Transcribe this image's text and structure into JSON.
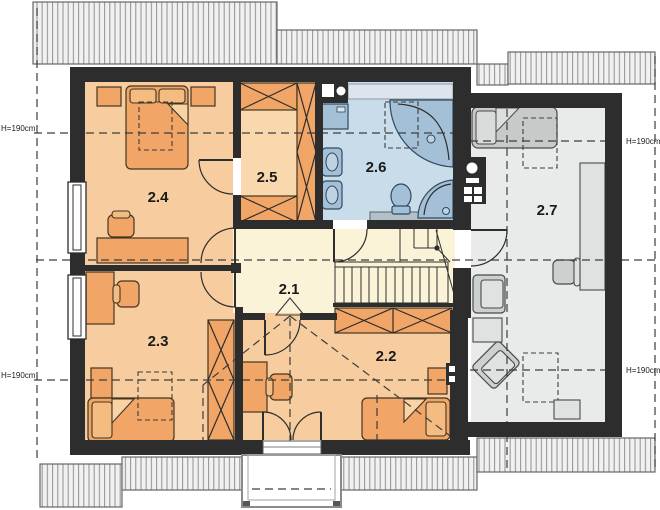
{
  "plan": {
    "title": "Attic floor plan",
    "rooms": [
      "2.1",
      "2.2",
      "2.3",
      "2.4",
      "2.5",
      "2.6",
      "2.7"
    ],
    "height_annotation": "H=190cm",
    "colors": {
      "wall": "#2d2d2d",
      "bedroom_floor": "#f7cd9f",
      "wardrobe_floor": "#f9d8ae",
      "hall_floor": "#faf3d8",
      "bathroom_floor": "#c9dcea",
      "attic_room_floor": "#e9ebea",
      "furniture_orange": "#f1a567",
      "furniture_gray": "#ccd1d0",
      "fixture_blue": "#a3c0d6",
      "roof_hatch": "#f1f1f1"
    }
  }
}
